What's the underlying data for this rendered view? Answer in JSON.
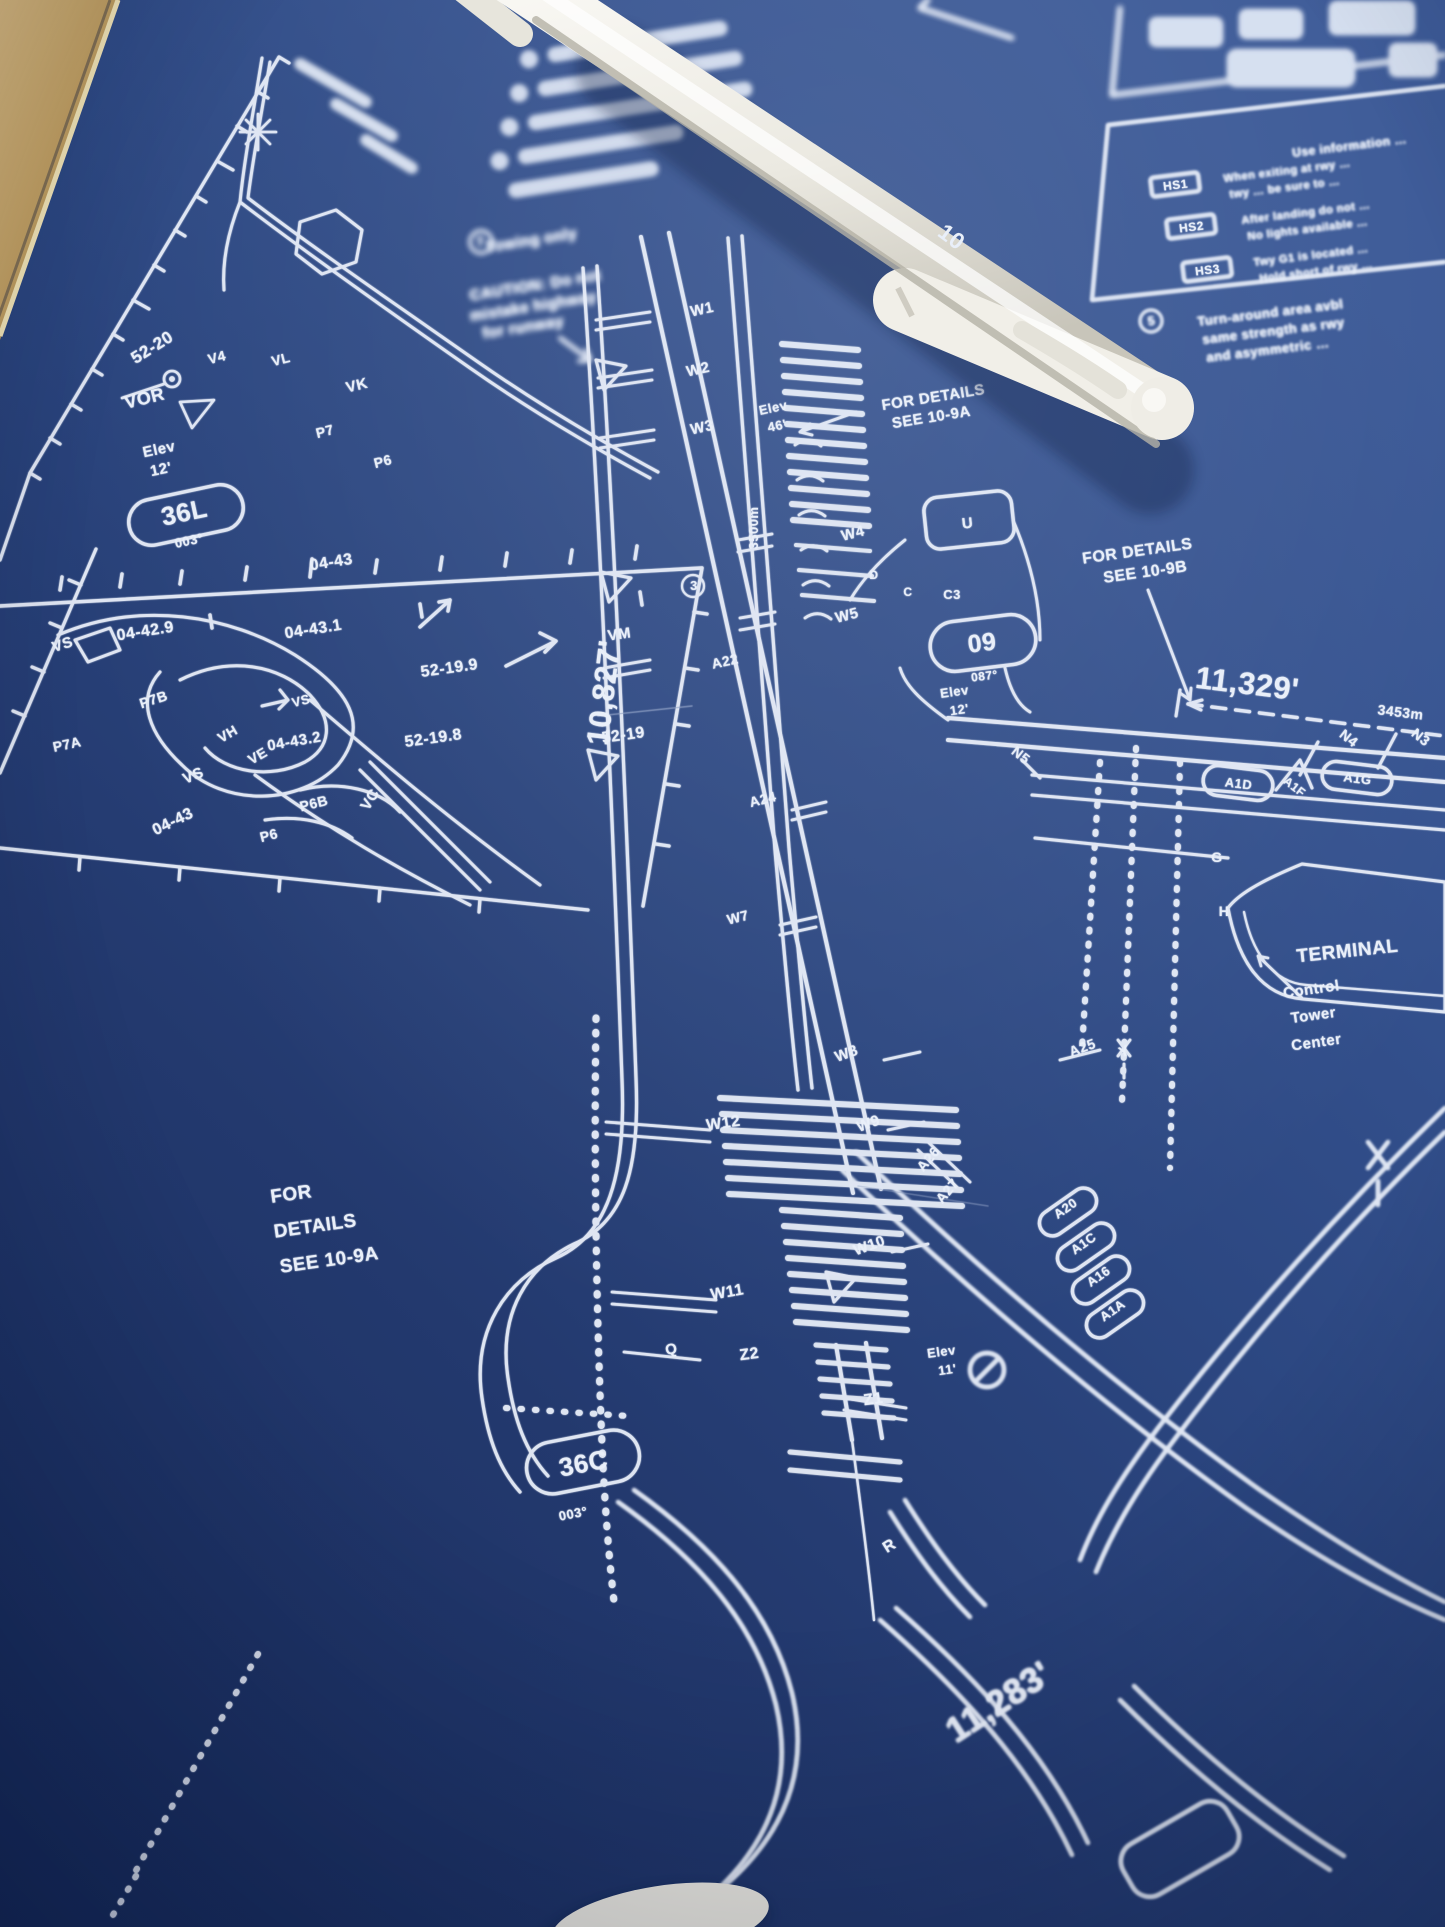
{
  "colors": {
    "paper_blue": "#2a4379",
    "ink_white": "#e9eff9",
    "desk_tan": "#c7a469",
    "pen_body": "#edebe3",
    "pen_print": "#8b8a60"
  },
  "pen": {
    "label": "10"
  },
  "map_labels": [
    {
      "t": "52-20",
      "x": 155,
      "y": 352,
      "r": -32,
      "s": 17,
      "n": "grid-label-52-20"
    },
    {
      "t": "VOR",
      "x": 146,
      "y": 404,
      "r": -14,
      "s": 18,
      "n": "vor-label"
    },
    {
      "t": "V4",
      "x": 218,
      "y": 362,
      "r": -14,
      "s": 14,
      "n": "taxiway-label-v4"
    },
    {
      "t": "VL",
      "x": 282,
      "y": 364,
      "r": -14,
      "s": 14,
      "n": "taxiway-label-vl"
    },
    {
      "t": "VK",
      "x": 358,
      "y": 390,
      "r": -14,
      "s": 15,
      "n": "taxiway-label-vk"
    },
    {
      "t": "P7",
      "x": 326,
      "y": 436,
      "r": -14,
      "s": 14,
      "n": "taxiway-label-p7"
    },
    {
      "t": "P6",
      "x": 384,
      "y": 466,
      "r": -14,
      "s": 14,
      "n": "taxiway-label-p6"
    },
    {
      "t": "Elev",
      "x": 160,
      "y": 454,
      "r": -12,
      "s": 15,
      "n": "elevation-label"
    },
    {
      "t": "12'",
      "x": 162,
      "y": 474,
      "r": -12,
      "s": 15,
      "n": "elevation-value"
    },
    {
      "t": "36L",
      "x": 186,
      "y": 521,
      "r": -12,
      "s": 26,
      "n": "runway-36L"
    },
    {
      "t": "003°",
      "x": 190,
      "y": 545,
      "r": -12,
      "s": 13,
      "n": "runway-36L-heading"
    },
    {
      "t": "04-43",
      "x": 332,
      "y": 567,
      "r": -9,
      "s": 16,
      "n": "grid-label"
    },
    {
      "t": "04-42.9",
      "x": 146,
      "y": 636,
      "r": -9,
      "s": 16,
      "n": "grid-label"
    },
    {
      "t": "04-43.1",
      "x": 314,
      "y": 634,
      "r": -9,
      "s": 16,
      "n": "grid-label"
    },
    {
      "t": "52-19.9",
      "x": 450,
      "y": 673,
      "r": -8,
      "s": 16,
      "n": "grid-label"
    },
    {
      "t": "52-19.8",
      "x": 434,
      "y": 743,
      "r": -8,
      "s": 16,
      "n": "grid-label"
    },
    {
      "t": "52-19",
      "x": 624,
      "y": 740,
      "r": -8,
      "s": 16,
      "n": "grid-label"
    },
    {
      "t": "VM",
      "x": 620,
      "y": 639,
      "r": -8,
      "s": 15,
      "n": "taxiway-label-vm"
    },
    {
      "t": "VS",
      "x": 64,
      "y": 649,
      "r": -18,
      "s": 15,
      "n": "taxiway-label-vs"
    },
    {
      "t": "P7B",
      "x": 155,
      "y": 704,
      "r": -18,
      "s": 14,
      "n": "taxiway-label-p7b"
    },
    {
      "t": "P7A",
      "x": 68,
      "y": 749,
      "r": -12,
      "s": 14,
      "n": "taxiway-label-p7a"
    },
    {
      "t": "VH",
      "x": 230,
      "y": 738,
      "r": -30,
      "s": 14,
      "n": "taxiway-label-vh"
    },
    {
      "t": "VE",
      "x": 260,
      "y": 760,
      "r": -30,
      "s": 14,
      "n": "taxiway-label-ve"
    },
    {
      "t": "VS",
      "x": 195,
      "y": 780,
      "r": -22,
      "s": 15,
      "n": "taxiway-label-vs"
    },
    {
      "t": "VS",
      "x": 302,
      "y": 705,
      "r": -14,
      "s": 13,
      "n": "taxiway-label-vs"
    },
    {
      "t": "P6B",
      "x": 315,
      "y": 808,
      "r": -14,
      "s": 14,
      "n": "taxiway-label-p6b"
    },
    {
      "t": "P6",
      "x": 270,
      "y": 840,
      "r": -14,
      "s": 14,
      "n": "taxiway-label-p6"
    },
    {
      "t": "VC",
      "x": 374,
      "y": 802,
      "r": -58,
      "s": 15,
      "n": "taxiway-label-vc"
    },
    {
      "t": "04-43.2",
      "x": 295,
      "y": 746,
      "r": -10,
      "s": 15,
      "n": "grid-label"
    },
    {
      "t": "04-43",
      "x": 175,
      "y": 826,
      "r": -26,
      "s": 16,
      "n": "grid-label"
    },
    {
      "t": "Towing only",
      "x": 532,
      "y": 245,
      "r": -9,
      "s": 15,
      "f": "top",
      "n": "note-towing-only"
    },
    {
      "t": "7",
      "x": 481,
      "y": 246,
      "r": -9,
      "s": 13,
      "f": "top",
      "n": "note-number-7"
    },
    {
      "t": "CAUTION: Do not",
      "x": 536,
      "y": 290,
      "r": -9,
      "s": 15,
      "f": "top",
      "n": "caution-note"
    },
    {
      "t": "mistake highway",
      "x": 534,
      "y": 311,
      "r": -9,
      "s": 15,
      "f": "top",
      "n": "caution-note"
    },
    {
      "t": "for runway",
      "x": 524,
      "y": 332,
      "r": -9,
      "s": 15,
      "f": "top",
      "n": "caution-note"
    },
    {
      "t": "W1",
      "x": 703,
      "y": 314,
      "r": -12,
      "s": 15,
      "n": "taxiway-label-w1"
    },
    {
      "t": "W2",
      "x": 699,
      "y": 374,
      "r": -12,
      "s": 15,
      "n": "taxiway-label-w2"
    },
    {
      "t": "W3",
      "x": 703,
      "y": 432,
      "r": -12,
      "s": 15,
      "n": "taxiway-label-w3"
    },
    {
      "t": "A22",
      "x": 726,
      "y": 666,
      "r": -12,
      "s": 14,
      "n": "taxiway-label-a22"
    },
    {
      "t": "A24",
      "x": 764,
      "y": 804,
      "r": -14,
      "s": 14,
      "n": "taxiway-label-a24"
    },
    {
      "t": "W7",
      "x": 739,
      "y": 922,
      "r": -14,
      "s": 14,
      "n": "taxiway-label-w7"
    },
    {
      "t": "3500m",
      "x": 758,
      "y": 528,
      "r": -90,
      "s": 13,
      "n": "runway-length-metric"
    },
    {
      "t": "W4",
      "x": 854,
      "y": 538,
      "r": -14,
      "s": 15,
      "n": "taxiway-label-w4"
    },
    {
      "t": "W5",
      "x": 848,
      "y": 620,
      "r": -14,
      "s": 15,
      "n": "taxiway-label-w5"
    },
    {
      "t": "U",
      "x": 968,
      "y": 528,
      "r": -6,
      "s": 15,
      "n": "taxiway-label-u"
    },
    {
      "t": "D",
      "x": 874,
      "y": 579,
      "r": 0,
      "s": 12,
      "n": "taxiway-label-d"
    },
    {
      "t": "C",
      "x": 908,
      "y": 596,
      "r": 0,
      "s": 12,
      "n": "taxiway-label-c"
    },
    {
      "t": "C3",
      "x": 952,
      "y": 599,
      "r": 0,
      "s": 13,
      "n": "taxiway-label-c3"
    },
    {
      "t": "3",
      "x": 694,
      "y": 590,
      "r": 0,
      "s": 13,
      "n": "note-number-3"
    },
    {
      "t": "10,827'",
      "x": 614,
      "y": 694,
      "r": -83,
      "s": 31,
      "n": "runway-length-main"
    },
    {
      "t": "Elev",
      "x": 774,
      "y": 412,
      "r": -12,
      "s": 13,
      "n": "elevation-label"
    },
    {
      "t": "46'",
      "x": 778,
      "y": 430,
      "r": -12,
      "s": 13,
      "n": "elevation-value"
    },
    {
      "t": "09",
      "x": 983,
      "y": 651,
      "r": -7,
      "s": 25,
      "n": "runway-09"
    },
    {
      "t": "087°",
      "x": 985,
      "y": 680,
      "r": -7,
      "s": 12,
      "n": "runway-09-heading"
    },
    {
      "t": "FOR DETAILS",
      "x": 934,
      "y": 402,
      "r": -9,
      "s": 15,
      "n": "see-ref-10-9a"
    },
    {
      "t": "SEE 10-9A",
      "x": 932,
      "y": 422,
      "r": -9,
      "s": 15,
      "n": "see-ref-10-9a"
    },
    {
      "t": "FOR DETAILS",
      "x": 1138,
      "y": 556,
      "r": -8,
      "s": 16,
      "n": "see-ref-10-9b"
    },
    {
      "t": "SEE 10-9B",
      "x": 1146,
      "y": 577,
      "r": -8,
      "s": 16,
      "n": "see-ref-10-9b"
    },
    {
      "t": "11,329'",
      "x": 1246,
      "y": 694,
      "r": 7,
      "s": 31,
      "n": "runway-length-09"
    },
    {
      "t": "3453m",
      "x": 1400,
      "y": 717,
      "r": 7,
      "s": 14,
      "n": "runway-length-09-metric"
    },
    {
      "t": "Elev",
      "x": 955,
      "y": 696,
      "r": -8,
      "s": 13,
      "n": "elevation-label"
    },
    {
      "t": "12'",
      "x": 960,
      "y": 714,
      "r": -8,
      "s": 13,
      "n": "elevation-value"
    },
    {
      "t": "N5",
      "x": 1018,
      "y": 759,
      "r": 38,
      "s": 14,
      "n": "taxiway-label-n5"
    },
    {
      "t": "N4",
      "x": 1346,
      "y": 742,
      "r": 38,
      "s": 14,
      "n": "taxiway-label-n4"
    },
    {
      "t": "N3",
      "x": 1418,
      "y": 741,
      "r": 38,
      "s": 14,
      "n": "taxiway-label-n3"
    },
    {
      "t": "A1D",
      "x": 1238,
      "y": 788,
      "r": 7,
      "s": 13,
      "n": "taxiway-label-a1d"
    },
    {
      "t": "A1F",
      "x": 1292,
      "y": 790,
      "r": 38,
      "s": 12,
      "n": "taxiway-label-a1f"
    },
    {
      "t": "A1G",
      "x": 1357,
      "y": 783,
      "r": 7,
      "s": 13,
      "n": "taxiway-label-a1g"
    },
    {
      "t": "G",
      "x": 1217,
      "y": 862,
      "r": 0,
      "s": 14,
      "n": "taxiway-label-g"
    },
    {
      "t": "H",
      "x": 1224,
      "y": 916,
      "r": 0,
      "s": 14,
      "n": "taxiway-label-h"
    },
    {
      "t": "TERMINAL",
      "x": 1348,
      "y": 957,
      "r": -6,
      "s": 19,
      "n": "terminal-label"
    },
    {
      "t": "Control",
      "x": 1312,
      "y": 994,
      "r": -8,
      "s": 15,
      "n": "control-tower-label"
    },
    {
      "t": "Tower",
      "x": 1314,
      "y": 1020,
      "r": -8,
      "s": 15,
      "n": "control-tower-label"
    },
    {
      "t": "Center",
      "x": 1317,
      "y": 1047,
      "r": -8,
      "s": 15,
      "n": "control-tower-label"
    },
    {
      "t": "W8",
      "x": 848,
      "y": 1058,
      "r": -20,
      "s": 15,
      "n": "taxiway-label-w8"
    },
    {
      "t": "W9",
      "x": 870,
      "y": 1128,
      "r": -20,
      "s": 15,
      "n": "taxiway-label-w9"
    },
    {
      "t": "W12",
      "x": 724,
      "y": 1128,
      "r": -8,
      "s": 16,
      "n": "taxiway-label-w12"
    },
    {
      "t": "W10",
      "x": 871,
      "y": 1250,
      "r": -20,
      "s": 15,
      "n": "taxiway-label-w10"
    },
    {
      "t": "W11",
      "x": 728,
      "y": 1297,
      "r": -10,
      "s": 16,
      "n": "taxiway-label-w11"
    },
    {
      "t": "A25",
      "x": 1084,
      "y": 1052,
      "r": -20,
      "s": 14,
      "n": "taxiway-label-a25"
    },
    {
      "t": "Y",
      "x": 1126,
      "y": 1056,
      "r": -20,
      "s": 15,
      "n": "taxiway-label-y"
    },
    {
      "t": "A26",
      "x": 932,
      "y": 1162,
      "r": -50,
      "s": 14,
      "n": "taxiway-label-a26"
    },
    {
      "t": "A27",
      "x": 951,
      "y": 1194,
      "r": -50,
      "s": 14,
      "n": "taxiway-label-a27"
    },
    {
      "t": "Q",
      "x": 672,
      "y": 1354,
      "r": -8,
      "s": 15,
      "n": "taxiway-label-q"
    },
    {
      "t": "Z2",
      "x": 750,
      "y": 1359,
      "r": -8,
      "s": 16,
      "n": "taxiway-label-z2"
    },
    {
      "t": "Z1",
      "x": 874,
      "y": 1404,
      "r": -8,
      "s": 16,
      "n": "taxiway-label-z1"
    },
    {
      "t": "Elev",
      "x": 942,
      "y": 1356,
      "r": -8,
      "s": 13,
      "n": "elevation-label"
    },
    {
      "t": "11'",
      "x": 948,
      "y": 1374,
      "r": -8,
      "s": 13,
      "n": "elevation-value"
    },
    {
      "t": "FOR",
      "x": 292,
      "y": 1200,
      "r": -8,
      "s": 19,
      "n": "see-ref-bottom"
    },
    {
      "t": "DETAILS",
      "x": 316,
      "y": 1232,
      "r": -8,
      "s": 19,
      "n": "see-ref-bottom"
    },
    {
      "t": "SEE 10-9A",
      "x": 330,
      "y": 1266,
      "r": -8,
      "s": 19,
      "n": "see-ref-bottom"
    },
    {
      "t": "36C",
      "x": 585,
      "y": 1472,
      "r": -11,
      "s": 26,
      "n": "runway-36C"
    },
    {
      "t": "003°",
      "x": 574,
      "y": 1518,
      "r": -11,
      "s": 13,
      "n": "runway-36C-heading"
    },
    {
      "t": "R",
      "x": 892,
      "y": 1550,
      "r": -32,
      "s": 16,
      "n": "taxiway-label-r"
    },
    {
      "t": "A20",
      "x": 1068,
      "y": 1212,
      "r": -35,
      "s": 13,
      "n": "taxiway-label-a20"
    },
    {
      "t": "A1C",
      "x": 1086,
      "y": 1247,
      "r": -35,
      "s": 13,
      "n": "taxiway-label-a1c"
    },
    {
      "t": "A16",
      "x": 1101,
      "y": 1280,
      "r": -35,
      "s": 13,
      "n": "taxiway-label-a16"
    },
    {
      "t": "A1A",
      "x": 1115,
      "y": 1314,
      "r": -35,
      "s": 13,
      "n": "taxiway-label-a1a"
    },
    {
      "t": "11,283'",
      "x": 1005,
      "y": 1712,
      "r": -33,
      "s": 35,
      "f": "bot",
      "n": "runway-length-bottom"
    },
    {
      "t": "Use information …",
      "x": 1350,
      "y": 150,
      "r": -7,
      "s": 12,
      "f": "hs",
      "n": "hotspot-header"
    },
    {
      "t": "HS1",
      "x": 1176,
      "y": 189,
      "r": -7,
      "s": 12,
      "n": "hotspot-1"
    },
    {
      "t": "HS2",
      "x": 1192,
      "y": 231,
      "r": -7,
      "s": 12,
      "n": "hotspot-2"
    },
    {
      "t": "HS3",
      "x": 1208,
      "y": 274,
      "r": -7,
      "s": 12,
      "n": "hotspot-3"
    },
    {
      "t": "When exiting at rwy …",
      "x": 1224,
      "y": 182,
      "r": -7,
      "s": 11,
      "a": "s",
      "f": "hs",
      "n": "hotspot-1-text"
    },
    {
      "t": "twy … be sure to …",
      "x": 1230,
      "y": 198,
      "r": -7,
      "s": 11,
      "a": "s",
      "f": "hs",
      "n": "hotspot-1-text"
    },
    {
      "t": "After landing do not …",
      "x": 1242,
      "y": 224,
      "r": -7,
      "s": 11,
      "a": "s",
      "f": "hs",
      "n": "hotspot-2-text"
    },
    {
      "t": "No lights available …",
      "x": 1248,
      "y": 240,
      "r": -7,
      "s": 11,
      "a": "s",
      "f": "hs",
      "n": "hotspot-2-text"
    },
    {
      "t": "Twy G1 is located …",
      "x": 1254,
      "y": 266,
      "r": -7,
      "s": 11,
      "a": "s",
      "f": "hs",
      "n": "hotspot-3-text"
    },
    {
      "t": "Hold short of rwy …",
      "x": 1260,
      "y": 282,
      "r": -7,
      "s": 11,
      "a": "s",
      "f": "hs",
      "n": "hotspot-3-text"
    },
    {
      "t": "5",
      "x": 1152,
      "y": 325,
      "r": -7,
      "s": 12,
      "f": "hs",
      "n": "note-number-5"
    },
    {
      "t": "Turn-around area avbl",
      "x": 1198,
      "y": 326,
      "r": -7,
      "s": 13,
      "a": "s",
      "f": "hs",
      "n": "turnaround-note"
    },
    {
      "t": "same strength as rwy",
      "x": 1203,
      "y": 344,
      "r": -7,
      "s": 13,
      "a": "s",
      "f": "hs",
      "n": "turnaround-note"
    },
    {
      "t": "and asymmetric …",
      "x": 1207,
      "y": 362,
      "r": -7,
      "s": 13,
      "a": "s",
      "f": "hs",
      "n": "turnaround-note"
    }
  ]
}
